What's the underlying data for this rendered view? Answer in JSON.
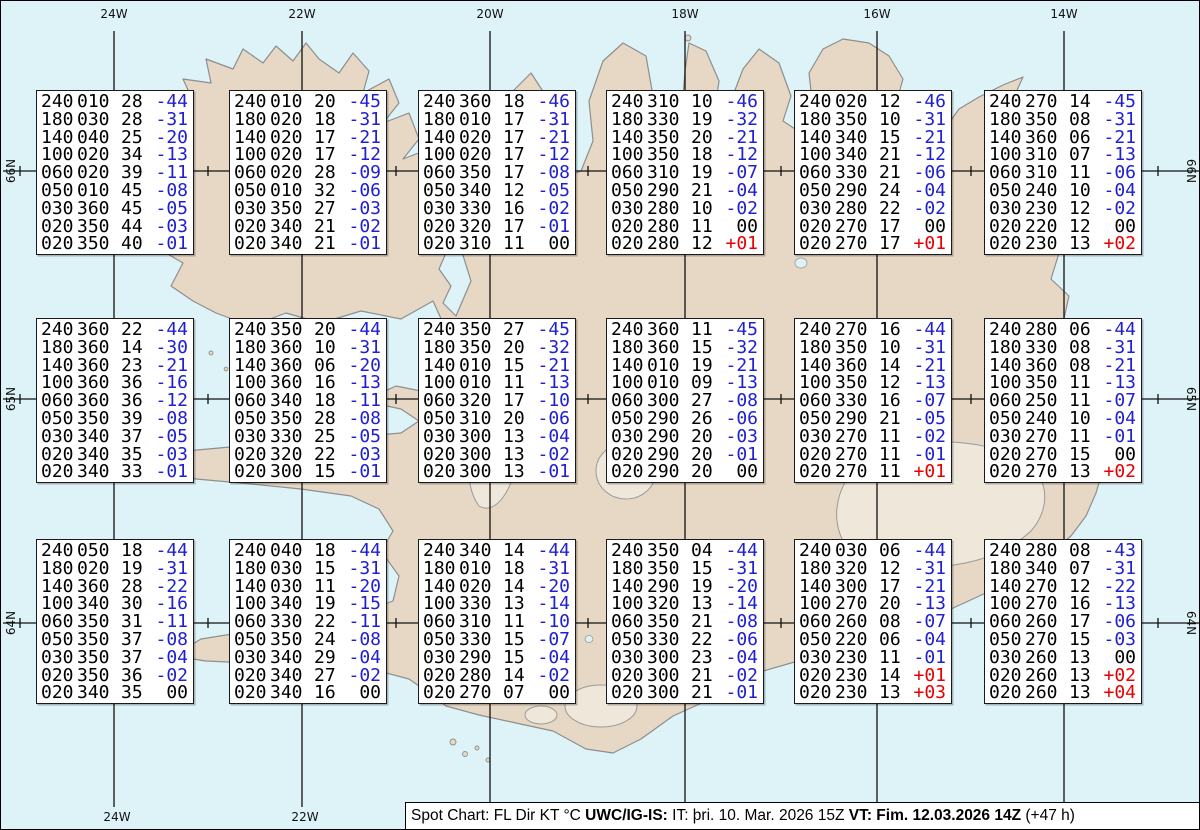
{
  "title": "Spot Chart",
  "chart_data": {
    "type": "table",
    "legend": "FL Dir KT °C",
    "lat_rows": [
      "66N",
      "65N",
      "64N"
    ],
    "lon_cols": [
      "24W",
      "22W",
      "20W",
      "18W",
      "16W",
      "14W"
    ],
    "points": [
      {
        "lat": "66N",
        "lon": "24W",
        "lines": [
          "240010 28 -44",
          "180030 28 -31",
          "140040 25 -20",
          "100020 34 -13",
          "060020 39 -11",
          "050010 45 -08",
          "030360 45 -05",
          "020350 44 -03",
          "020350 40 -01"
        ]
      },
      {
        "lat": "66N",
        "lon": "22W",
        "lines": [
          "240010 20 -45",
          "180020 18 -31",
          "140020 17 -21",
          "100020 17 -12",
          "060020 28 -09",
          "050010 32 -06",
          "030350 27 -03",
          "020340 21 -02",
          "020340 21 -01"
        ]
      },
      {
        "lat": "66N",
        "lon": "20W",
        "lines": [
          "240360 18 -46",
          "180010 17 -31",
          "140020 17 -21",
          "100020 17 -12",
          "060350 17 -08",
          "050340 12 -05",
          "030330 16 -02",
          "020320 17 -01",
          "020310 11  00"
        ]
      },
      {
        "lat": "66N",
        "lon": "18W",
        "lines": [
          "240310 10 -46",
          "180330 19 -32",
          "140350 20 -21",
          "100350 18 -12",
          "060310 19 -07",
          "050290 21 -04",
          "030280 10 -02",
          "020280 11  00",
          "020280 12 +01"
        ]
      },
      {
        "lat": "66N",
        "lon": "16W",
        "lines": [
          "240020 12 -46",
          "180350 10 -31",
          "140340 15 -21",
          "100340 21 -12",
          "060330 21 -06",
          "050290 24 -04",
          "030280 22 -02",
          "020270 17  00",
          "020270 17 +01"
        ]
      },
      {
        "lat": "66N",
        "lon": "14W",
        "lines": [
          "240270 14 -45",
          "180350 08 -31",
          "140360 06 -21",
          "100310 07 -13",
          "060310 11 -06",
          "050240 10 -04",
          "030230 12 -02",
          "020220 12  00",
          "020230 13 +02"
        ]
      },
      {
        "lat": "65N",
        "lon": "24W",
        "lines": [
          "240360 22 -44",
          "180360 14 -30",
          "140360 23 -21",
          "100360 36 -16",
          "060360 36 -12",
          "050350 39 -08",
          "030340 37 -05",
          "020340 35 -03",
          "020340 33 -01"
        ]
      },
      {
        "lat": "65N",
        "lon": "22W",
        "lines": [
          "240350 20 -44",
          "180360 10 -31",
          "140360 06 -20",
          "100360 16 -13",
          "060340 18 -11",
          "050350 28 -08",
          "030330 25 -05",
          "020320 22 -03",
          "020300 15 -01"
        ]
      },
      {
        "lat": "65N",
        "lon": "20W",
        "lines": [
          "240350 27 -45",
          "180350 20 -32",
          "140010 15 -21",
          "100010 11 -13",
          "060320 17 -10",
          "050310 20 -06",
          "030300 13 -04",
          "020300 13 -02",
          "020300 13 -01"
        ]
      },
      {
        "lat": "65N",
        "lon": "18W",
        "lines": [
          "240360 11 -45",
          "180360 15 -32",
          "140010 19 -21",
          "100010 09 -13",
          "060300 27 -08",
          "050290 26 -06",
          "030290 20 -03",
          "020290 20 -01",
          "020290 20  00"
        ]
      },
      {
        "lat": "65N",
        "lon": "16W",
        "lines": [
          "240270 16 -44",
          "180350 10 -31",
          "140360 14 -21",
          "100350 12 -13",
          "060330 16 -07",
          "050290 21 -05",
          "030270 11 -02",
          "020270 11 -01",
          "020270 11 +01"
        ]
      },
      {
        "lat": "65N",
        "lon": "14W",
        "lines": [
          "240280 06 -44",
          "180330 08 -31",
          "140360 08 -21",
          "100350 11 -13",
          "060250 11 -07",
          "050240 10 -04",
          "030270 11 -01",
          "020270 15  00",
          "020270 13 +02"
        ]
      },
      {
        "lat": "64N",
        "lon": "24W",
        "lines": [
          "240050 18 -44",
          "180020 19 -31",
          "140360 28 -22",
          "100340 30 -16",
          "060350 31 -11",
          "050350 37 -08",
          "030350 37 -04",
          "020350 36 -02",
          "020340 35  00"
        ]
      },
      {
        "lat": "64N",
        "lon": "22W",
        "lines": [
          "240040 18 -44",
          "180030 15 -31",
          "140030 11 -20",
          "100340 19 -15",
          "060330 22 -11",
          "050350 24 -08",
          "030340 29 -04",
          "020340 27 -02",
          "020340 16  00"
        ]
      },
      {
        "lat": "64N",
        "lon": "20W",
        "lines": [
          "240340 14 -44",
          "180010 18 -31",
          "140020 14 -20",
          "100330 13 -14",
          "060310 11 -10",
          "050330 15 -07",
          "030290 15 -04",
          "020280 14 -02",
          "020270 07  00"
        ]
      },
      {
        "lat": "64N",
        "lon": "18W",
        "lines": [
          "240350 04 -44",
          "180350 15 -31",
          "140290 19 -20",
          "100320 13 -14",
          "060350 21 -08",
          "050330 22 -06",
          "030300 23 -04",
          "020300 21 -02",
          "020300 21 -01"
        ]
      },
      {
        "lat": "64N",
        "lon": "16W",
        "lines": [
          "240030 06 -44",
          "180320 12 -31",
          "140300 17 -21",
          "100270 20 -13",
          "060260 08 -07",
          "050220 06 -04",
          "030230 11 -01",
          "020230 14 +01",
          "020230 13 +03"
        ]
      },
      {
        "lat": "64N",
        "lon": "14W",
        "lines": [
          "240280 08 -43",
          "180340 07 -31",
          "140270 12 -22",
          "100270 16 -13",
          "060260 17 -06",
          "050270 15 -03",
          "030260 13  00",
          "020260 13 +02",
          "020260 13 +04"
        ]
      }
    ]
  },
  "axes": {
    "top": [
      "24W",
      "22W",
      "20W",
      "18W",
      "16W",
      "14W"
    ],
    "bottom": [
      "24W",
      "22W"
    ],
    "left": [
      "66N",
      "65N",
      "64N"
    ],
    "right": [
      "66N",
      "65N",
      "64N"
    ]
  },
  "footer": {
    "segments": [
      {
        "text": "Spot Chart: FL Dir KT °C ",
        "bold": false
      },
      {
        "text": "UWC/IG-IS:",
        "bold": true
      },
      {
        "text": " IT: þri. 10. Mar. 2026 15Z ",
        "bold": false
      },
      {
        "text": "VT: Fim. 12.03.2026 14Z",
        "bold": true
      },
      {
        "text": " (+47 h)",
        "bold": false
      }
    ]
  },
  "colors": {
    "water": "#ddf3f8",
    "land": "#e7d8c5",
    "glacier": "#efe7da",
    "coastline": "#8e8e8e",
    "grid": "#111111",
    "temp_negative": "#2020d0",
    "temp_positive": "#e80000",
    "temp_zero": "#000000"
  }
}
